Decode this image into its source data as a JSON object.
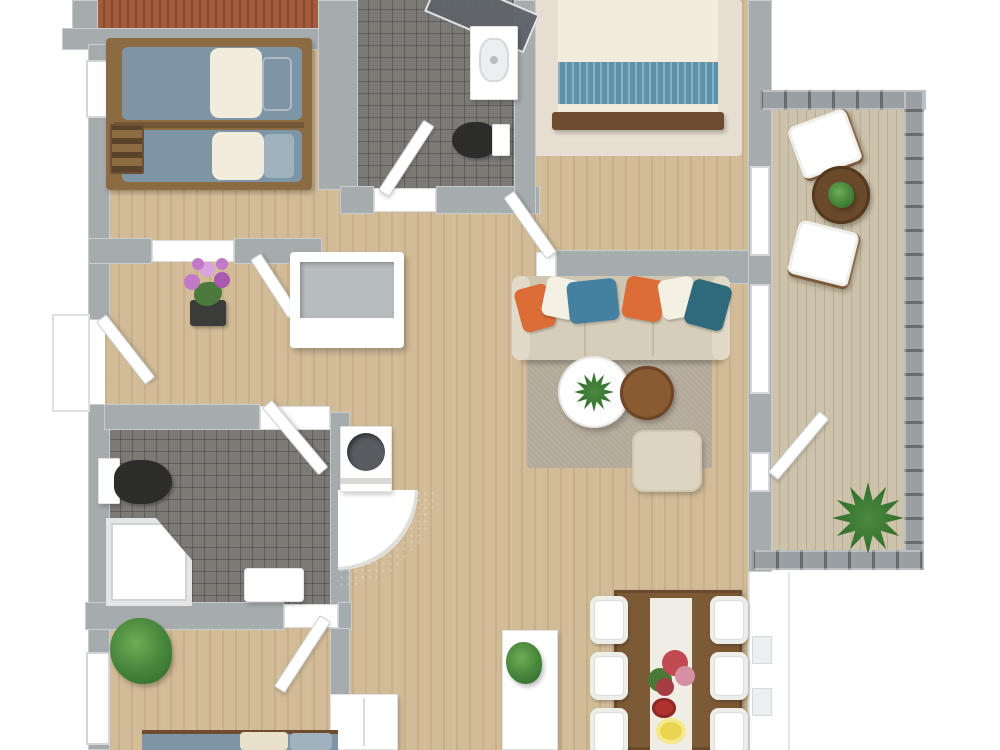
{
  "scene": {
    "type": "floor-plan-3d-top-view",
    "rooms": [
      {
        "name": "bunk-bedroom",
        "floor": "wood",
        "furniture": [
          "bunk-bed",
          "ladder",
          "window"
        ]
      },
      {
        "name": "top-bathroom",
        "floor": "dark-tile",
        "furniture": [
          "corner-shower",
          "sink-vanity",
          "toilet",
          "door"
        ]
      },
      {
        "name": "master-bedroom",
        "floor": "wood",
        "furniture": [
          "double-bed",
          "area-rug",
          "door"
        ]
      },
      {
        "name": "hallway",
        "floor": "wood",
        "furniture": [
          "orchid-plant-stand",
          "storage-bench",
          "corner-fireplace"
        ]
      },
      {
        "name": "living-room",
        "floor": "wood",
        "furniture": [
          "sofa",
          "six-pillows",
          "round-coffee-table",
          "round-side-table",
          "pouf",
          "area-rug"
        ]
      },
      {
        "name": "left-bathroom",
        "floor": "dark-tile",
        "furniture": [
          "toilet",
          "corner-shower",
          "bath-mat",
          "door"
        ]
      },
      {
        "name": "bottom-bedroom",
        "floor": "wood",
        "furniture": [
          "bed",
          "wardrobe",
          "potted-plant",
          "door",
          "window"
        ]
      },
      {
        "name": "dining-area",
        "floor": "wood",
        "furniture": [
          "dining-table",
          "table-runner",
          "six-chairs",
          "sideboard",
          "plant",
          "flower-bouquet",
          "red-bowl",
          "yellow-plate"
        ]
      },
      {
        "name": "balcony",
        "floor": "deck",
        "furniture": [
          "two-sling-chairs",
          "round-table",
          "table-plant",
          "floor-plant",
          "railing"
        ]
      },
      {
        "name": "top-deck",
        "floor": "red-deck",
        "furniture": []
      }
    ],
    "sofa_pillow_colors": [
      "orange",
      "white",
      "blue",
      "orange",
      "white",
      "dark-teal"
    ]
  },
  "palette": {
    "wall": "#a6abae",
    "wall_edge": "#c9cdcf",
    "wood": "#d2bb97",
    "deck": "#cdc2aa",
    "deck_red": "#a25c3b",
    "tile": "#7c7a75",
    "white": "#ffffff",
    "rug_beige": "#e7e0d2",
    "rug_taupe": "#b2a999",
    "sofa": "#d6cdba",
    "sofa_arm": "#e2dac8",
    "sofa_back": "#cfc6b2",
    "pillow_orange": "#dd6d36",
    "pillow_blue": "#44809f",
    "pillow_teal": "#2e6a7c",
    "pillow_white": "#f4f0e3",
    "duvet": "#f2ecdc",
    "bed_teal": "#5d93aa",
    "wood_dark": "#6f4b30",
    "table_brown": "#8a5a33",
    "dining_brown": "#7d5a36",
    "mattress": "#7e95a6",
    "mattress_light": "#9fb2bd",
    "bunk_frame": "#8c6b42",
    "green": "#4c8a3f",
    "green_dark": "#2f6b2a",
    "orchid": "#c07ac8",
    "fixture_black": "#2c2c2a",
    "fixture_gray": "#585c60",
    "rug_black": "#242422",
    "runner": "#f0ede4",
    "bowl_red": "#b23230",
    "plate_yellow": "#e9d54f",
    "pouf": "#ddd5c2",
    "glass": "#5f646a"
  }
}
